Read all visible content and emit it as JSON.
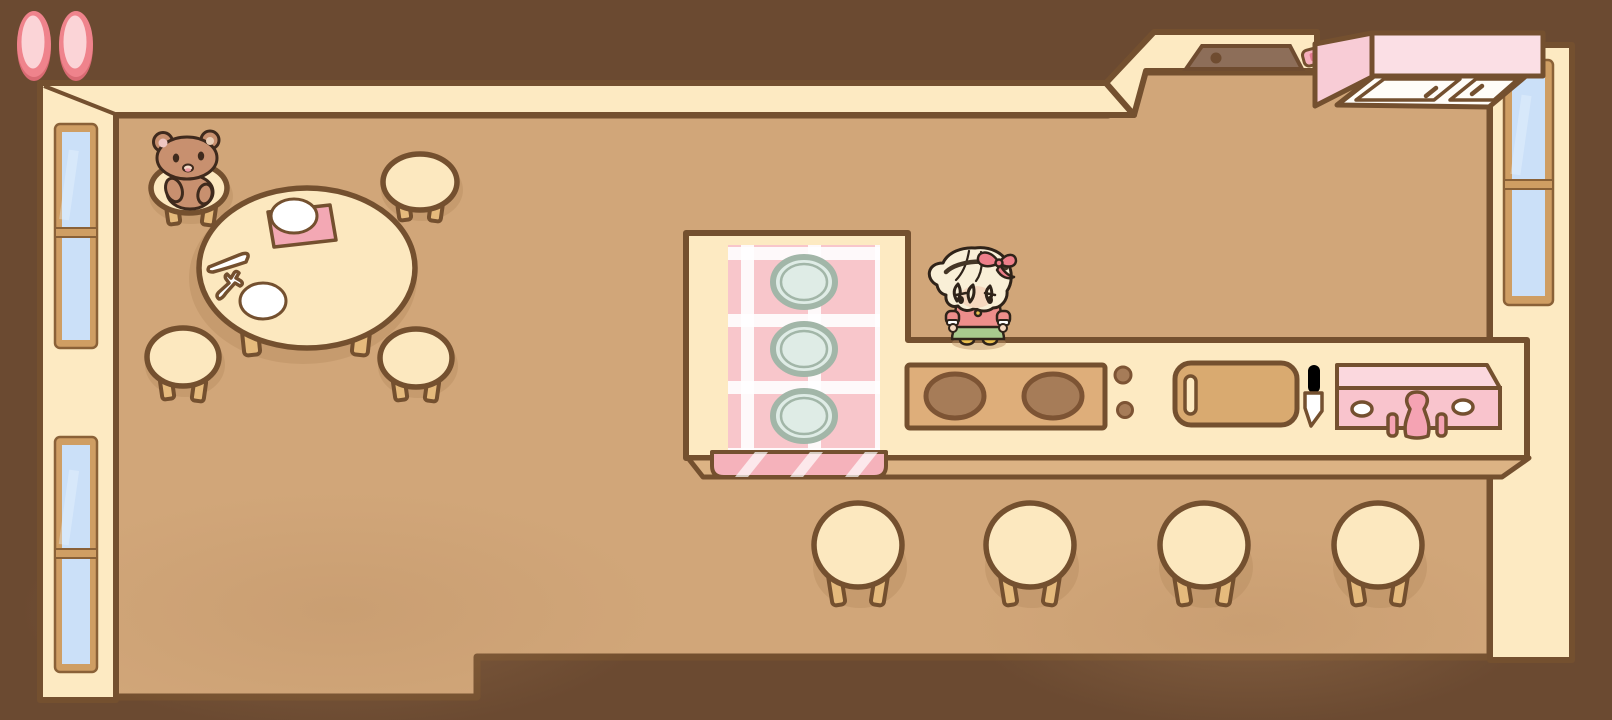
{
  "window": {
    "width": 1612,
    "height": 720
  },
  "hud": {
    "pause_button": {
      "icon": "pause-icon",
      "bars": 2
    }
  },
  "scene": {
    "description": "top-down cozy kitchen and dining room",
    "characters": [
      {
        "name": "player-girl",
        "hair": "blonde",
        "accessory": "pink bow",
        "shirt": "salmon",
        "skirt": "green",
        "shoes": "mustard"
      },
      {
        "name": "teddy-bear",
        "color": "brown",
        "seated_on": "dining-stool"
      }
    ],
    "furniture": {
      "dining_table": {
        "shape": "round",
        "stools": 4,
        "items_on_table": [
          "white-plate",
          "white-plate",
          "pink-napkin",
          "knife",
          "fork"
        ]
      },
      "kitchen_counter": {
        "sections": [
          "gingham-buffet",
          "stove",
          "cutting-board",
          "pink-sink"
        ],
        "plates_on_gingham": 3,
        "stove_burners": 2,
        "stove_knobs": 2,
        "counter_stools": 4
      },
      "upper_cabinet": {
        "doors": 2
      },
      "wall_counter": {
        "basin": 1,
        "sponge": 1
      },
      "windows_left_wall": 2,
      "windows_right_wall": 1
    }
  },
  "palette": {
    "void": "#6b4a31",
    "wallCream": "#fdeac2",
    "wallOutline": "#74502f",
    "windowFrame": "#cf9e63",
    "windowFrameEdge": "#8a6137",
    "windowPane": "#cbe0f8",
    "floor": "#d1a679",
    "floorShadow": "#b98d62",
    "furnCream": "#fce8bf",
    "furnLeg": "#e5ba7c",
    "counterEdge": "#dcb384",
    "clothPink": "#f8c6cb",
    "clothFlap": "#f5b2bb",
    "napkin": "#f3a8b4",
    "plateFill": "#dfece6",
    "plateRim": "#a2b6a8",
    "stoveInset": "#deae7a",
    "burner": "#a67c58",
    "burnerEdge": "#7d5434",
    "board": "#d9aa70",
    "sinkTop": "#fbd8de",
    "sinkFront": "#f9c4cd",
    "sinkFixture": "#f5a3b3",
    "cabinetSide": "#f8ccd6",
    "cabinetFront": "#fbdfe5",
    "cabinetUnder": "#fffdf8",
    "basin": "#8d6e59",
    "basinEdge": "#6f4c30",
    "sponge": "#f6afbc",
    "spongeMark": "#e2798f",
    "pauseOuter": "#ef838c",
    "pauseInner": "#fbd4d7",
    "pauseShade": "#d96a73",
    "bear": "#c8906f",
    "bearDark": "#3f2a1d",
    "bearEar": "#eec6c2",
    "bearEarR": "#e9cdb6",
    "bearMouth": "#f4d9c8",
    "bearTongue": "#ef9aa2",
    "girlHair": "#f9efd7",
    "girlLine": "#2f2319",
    "girlBand": "#453626",
    "girlBow": "#ee7f8a",
    "girlShirt": "#ee8e8b",
    "girlSkirt": "#a8ca8e",
    "girlShoes": "#e9bf4e",
    "girlSkin": "#f6d8bf",
    "white": "#ffffff"
  }
}
